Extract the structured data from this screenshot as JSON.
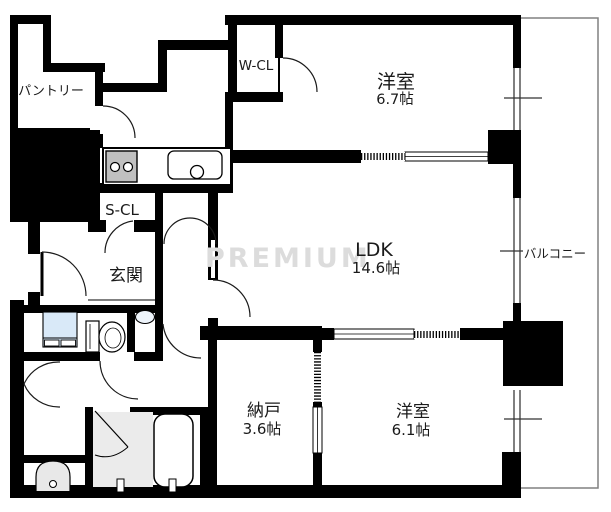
{
  "rooms": {
    "pantry": {
      "label": "パントリー"
    },
    "walk_in_closet": {
      "label": "W-CL"
    },
    "bedroom_67": {
      "label": "洋室",
      "size": "6.7帖"
    },
    "shoe_closet": {
      "label": "S-CL"
    },
    "ldk": {
      "label": "LDK",
      "size": "14.6帖"
    },
    "entrance": {
      "label": "玄関"
    },
    "storage": {
      "label": "納戸",
      "size": "3.6帖"
    },
    "bedroom_61": {
      "label": "洋室",
      "size": "6.1帖"
    },
    "balcony": {
      "label": "バルコニー"
    }
  },
  "watermark": {
    "text": "PREMIUM"
  },
  "fixtures": {
    "stove": "gas-stove-2-burner",
    "kitchen_sink": "kitchen-sink",
    "toilet": "toilet",
    "vanity": "washer-vanity",
    "hand_basin": "hand-basin",
    "bathtub": "bathtub",
    "wash_basin": "pedestal-basin"
  },
  "colors": {
    "wall": "#000000",
    "stove_fill": "#c0c0c0",
    "bath_floor": "#ebebeb",
    "vanity_fill": "#d9e9f8",
    "watermark": "#dcdcdc",
    "balcony_line": "#808080"
  }
}
